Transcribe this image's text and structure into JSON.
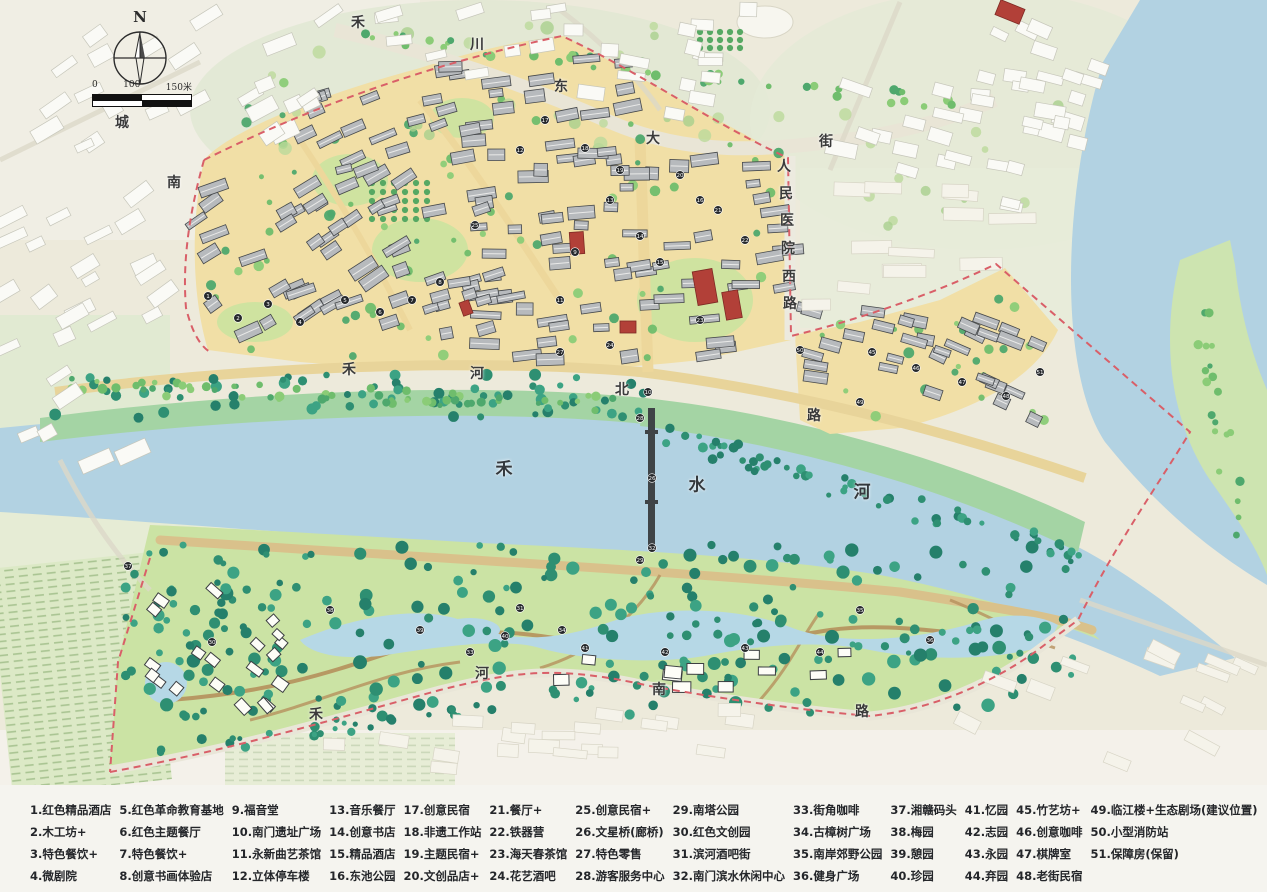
{
  "map": {
    "compass": {
      "label": "N"
    },
    "scale": {
      "t0": "0",
      "t1": "100",
      "t2": "150米"
    },
    "river_name": "禾水河",
    "streets": [
      "禾川东大街",
      "人民医院西路",
      "禾河北路",
      "禾河南路",
      "城南"
    ],
    "labels": [
      {
        "text": "禾",
        "x": 358,
        "y": 22
      },
      {
        "text": "川",
        "x": 477,
        "y": 44
      },
      {
        "text": "东",
        "x": 561,
        "y": 86
      },
      {
        "text": "大",
        "x": 653,
        "y": 138
      },
      {
        "text": "街",
        "x": 826,
        "y": 141
      },
      {
        "text": "人",
        "x": 784,
        "y": 166
      },
      {
        "text": "民",
        "x": 786,
        "y": 193
      },
      {
        "text": "医",
        "x": 787,
        "y": 220
      },
      {
        "text": "院",
        "x": 788,
        "y": 248
      },
      {
        "text": "西",
        "x": 789,
        "y": 276
      },
      {
        "text": "路",
        "x": 790,
        "y": 303
      },
      {
        "text": "城",
        "x": 122,
        "y": 122
      },
      {
        "text": "南",
        "x": 174,
        "y": 182
      },
      {
        "text": "禾",
        "x": 349,
        "y": 369
      },
      {
        "text": "河",
        "x": 477,
        "y": 373
      },
      {
        "text": "北",
        "x": 622,
        "y": 389
      },
      {
        "text": "路",
        "x": 814,
        "y": 415
      },
      {
        "text": "禾",
        "x": 504,
        "y": 467,
        "big": true
      },
      {
        "text": "水",
        "x": 697,
        "y": 483,
        "big": true
      },
      {
        "text": "河",
        "x": 862,
        "y": 490,
        "big": true
      },
      {
        "text": "禾",
        "x": 316,
        "y": 714
      },
      {
        "text": "河",
        "x": 482,
        "y": 673
      },
      {
        "text": "南",
        "x": 659,
        "y": 689
      },
      {
        "text": "路",
        "x": 862,
        "y": 711
      }
    ],
    "markers": [
      {
        "n": 1,
        "x": 208,
        "y": 296
      },
      {
        "n": 2,
        "x": 238,
        "y": 318
      },
      {
        "n": 3,
        "x": 268,
        "y": 304
      },
      {
        "n": 4,
        "x": 300,
        "y": 322
      },
      {
        "n": 5,
        "x": 345,
        "y": 300
      },
      {
        "n": 6,
        "x": 380,
        "y": 312
      },
      {
        "n": 7,
        "x": 412,
        "y": 300
      },
      {
        "n": 8,
        "x": 440,
        "y": 282
      },
      {
        "n": 9,
        "x": 575,
        "y": 252
      },
      {
        "n": 10,
        "x": 648,
        "y": 392
      },
      {
        "n": 11,
        "x": 560,
        "y": 300
      },
      {
        "n": 12,
        "x": 520,
        "y": 150
      },
      {
        "n": 13,
        "x": 610,
        "y": 200
      },
      {
        "n": 14,
        "x": 640,
        "y": 236
      },
      {
        "n": 15,
        "x": 660,
        "y": 262
      },
      {
        "n": 16,
        "x": 700,
        "y": 200
      },
      {
        "n": 17,
        "x": 545,
        "y": 120
      },
      {
        "n": 18,
        "x": 585,
        "y": 148
      },
      {
        "n": 19,
        "x": 620,
        "y": 170
      },
      {
        "n": 20,
        "x": 680,
        "y": 175
      },
      {
        "n": 21,
        "x": 718,
        "y": 210
      },
      {
        "n": 22,
        "x": 745,
        "y": 240
      },
      {
        "n": 23,
        "x": 700,
        "y": 320
      },
      {
        "n": 24,
        "x": 610,
        "y": 345
      },
      {
        "n": 25,
        "x": 475,
        "y": 225
      },
      {
        "n": 26,
        "x": 652,
        "y": 478
      },
      {
        "n": 27,
        "x": 560,
        "y": 352
      },
      {
        "n": 28,
        "x": 640,
        "y": 418
      },
      {
        "n": 29,
        "x": 640,
        "y": 560
      },
      {
        "n": 30,
        "x": 212,
        "y": 642
      },
      {
        "n": 31,
        "x": 520,
        "y": 608
      },
      {
        "n": 32,
        "x": 652,
        "y": 548
      },
      {
        "n": 33,
        "x": 470,
        "y": 652
      },
      {
        "n": 34,
        "x": 562,
        "y": 630
      },
      {
        "n": 35,
        "x": 860,
        "y": 610
      },
      {
        "n": 36,
        "x": 930,
        "y": 640
      },
      {
        "n": 37,
        "x": 128,
        "y": 566
      },
      {
        "n": 38,
        "x": 330,
        "y": 610
      },
      {
        "n": 39,
        "x": 420,
        "y": 630
      },
      {
        "n": 40,
        "x": 505,
        "y": 636
      },
      {
        "n": 41,
        "x": 585,
        "y": 648
      },
      {
        "n": 42,
        "x": 665,
        "y": 652
      },
      {
        "n": 43,
        "x": 745,
        "y": 648
      },
      {
        "n": 44,
        "x": 820,
        "y": 652
      },
      {
        "n": 45,
        "x": 872,
        "y": 352
      },
      {
        "n": 46,
        "x": 916,
        "y": 368
      },
      {
        "n": 47,
        "x": 962,
        "y": 382
      },
      {
        "n": 48,
        "x": 1006,
        "y": 396
      },
      {
        "n": 49,
        "x": 860,
        "y": 402
      },
      {
        "n": 50,
        "x": 800,
        "y": 350
      },
      {
        "n": 51,
        "x": 1040,
        "y": 372
      }
    ],
    "colors": {
      "water": "#b2d2e2",
      "town_ground": "#f1dfa6",
      "park": "#cbe3a4",
      "boundary": "#d95f68",
      "building_gray": "#b7babd",
      "heritage_red": "#b24038",
      "bank_green": "#a4d4a4",
      "paper": "#edeadb"
    }
  },
  "legend": {
    "columns": [
      [
        "1.红色精品酒店",
        "2.木工坊+",
        "3.特色餐饮+",
        "4.微剧院"
      ],
      [
        "5.红色革命教育基地",
        "6.红色主题餐厅",
        "7.特色餐饮+",
        "8.创意书画体验店"
      ],
      [
        "9.福音堂",
        "10.南门遗址广场",
        "11.永新曲艺茶馆",
        "12.立体停车楼"
      ],
      [
        "13.音乐餐厅",
        "14.创意书店",
        "15.精品酒店",
        "16.东池公园"
      ],
      [
        "17.创意民宿",
        "18.非遗工作站",
        "19.主题民宿+",
        "20.文创品店+"
      ],
      [
        "21.餐厅+",
        "22.铁器营",
        "23.海天春茶馆",
        "24.花艺酒吧"
      ],
      [
        "25.创意民宿+",
        "26.文星桥(廊桥)",
        "27.特色零售",
        "28.游客服务中心"
      ],
      [
        "29.南塔公园",
        "30.红色文创园",
        "31.滨河酒吧街",
        "32.南门滨水休闲中心"
      ],
      [
        "33.街角咖啡",
        "34.古樟树广场",
        "35.南岸郊野公园",
        "36.健身广场"
      ],
      [
        "37.湘赣码头",
        "38.梅园",
        "39.憩园",
        "40.珍园"
      ],
      [
        "41.忆园",
        "42.志园",
        "43.永园",
        "44.弃园"
      ],
      [
        "45.竹艺坊+",
        "46.创意咖啡",
        "47.棋牌室",
        "48.老街民宿"
      ],
      [
        "49.临江楼+生态剧场(建议位置)",
        "50.小型消防站",
        "51.保障房(保留)"
      ]
    ]
  }
}
